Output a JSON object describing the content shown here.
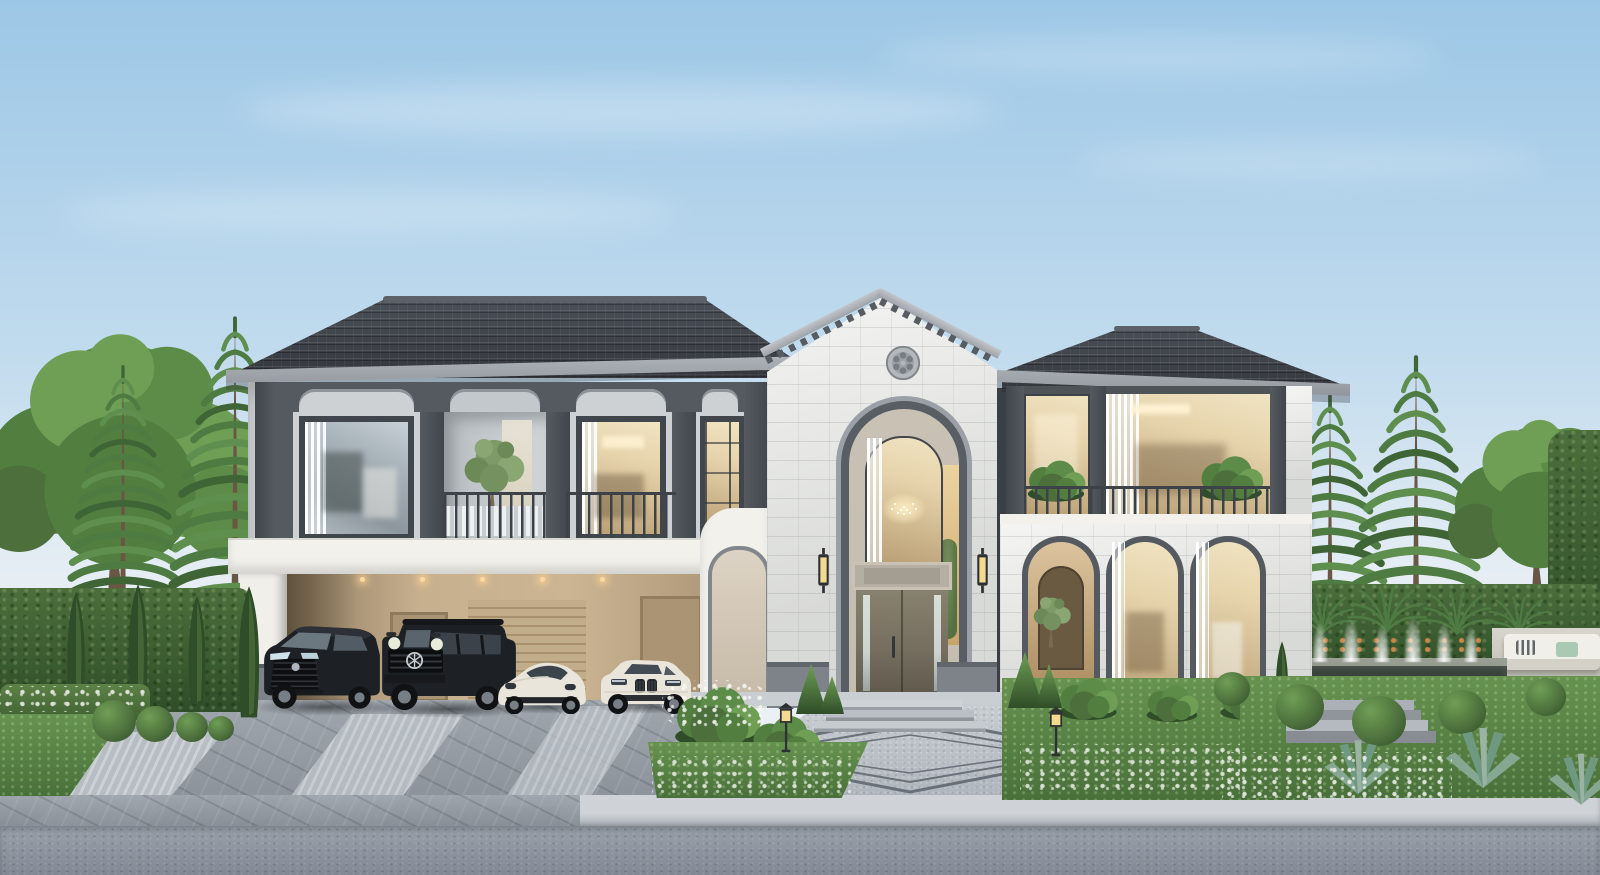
{
  "scene": {
    "type": "architectural-exterior-3d-render",
    "subject": "Two-story luxury modern-classical house with central gabled entry tower, arched entrance, carport with four cars, paver driveway, landscaped gardens, fountain and tall pine trees under a clear blue sky",
    "time_of_day": "daytime",
    "weather": "clear with thin clouds"
  },
  "house": {
    "style": "modern classical",
    "stories": 2,
    "left_wing": {
      "upper_bays": 4,
      "balcony": "open bay with olive tree and railing",
      "carport_cars": 4
    },
    "entry_tower": {
      "gable": "dentil rake boards",
      "rosette_medallion": true,
      "arched_window": "grid glazing with chandelier",
      "door": "grey double door with mirror sidelights",
      "wall_sconces": 2
    },
    "right_wing": {
      "upper": "glazed balcony with planters and railing",
      "ground_arches": 3,
      "first_arch": "open porch with tree"
    }
  },
  "vehicles": [
    {
      "name": "black-luxury-minivan",
      "color": "#1d2125"
    },
    {
      "name": "black-boxy-suv",
      "color": "#191c1f"
    },
    {
      "name": "white-sports-sedan",
      "color": "#eae5da"
    },
    {
      "name": "white-luxury-sedan",
      "color": "#ece8dd"
    }
  ],
  "landscape": {
    "left": [
      "deciduous tree",
      "norfolk pine",
      "norfolk pine",
      "tall hedge wall",
      "cypress shrubs",
      "boxwood balls",
      "lawn",
      "white flower bed"
    ],
    "right": [
      "norfolk pine",
      "norfolk pine",
      "deciduous tree",
      "hedge wall",
      "palm rosettes",
      "fountain pool with water jets",
      "outdoor lounge sofa",
      "garden steps",
      "boxwood balls",
      "agaves",
      "white flower bed",
      "cypress"
    ],
    "front": [
      "white flower beds",
      "garden lantern posts",
      "conical shrubs",
      "paver driveway with light stripes",
      "granite walkway with diamond inlay",
      "entry steps",
      "street curb",
      "asphalt road"
    ]
  },
  "colors": {
    "sky_top": "#9cc7e6",
    "sky_mid": "#c3dcee",
    "sky_horizon": "#e6eef4",
    "roof_dark": "#33373d",
    "roof_light": "#4d525a",
    "ridge": "#5d626a",
    "fascia_a": "#b0b5ba",
    "fascia_b": "#8f959b",
    "pier": "#555a61",
    "pier_dark": "#41464c",
    "wall_light": "#cdd1d4",
    "wall_recess": "#c3c8cc",
    "stone": "#e7e8e5",
    "band_white": "#f2f1ec",
    "carport_a": "#c7b08e",
    "carport_b": "#8d7a5f",
    "carport_door": "#ab9473",
    "glass_cool1": "#c7d1d6",
    "glass_cool2": "#8d979e",
    "glass_warm1": "#e6d3ab",
    "glass_warm2": "#b89d72",
    "reveal": "#c4bdb0",
    "door": "#766f60",
    "door_dark": "#5f594c",
    "sidelight": "#ccd3cf",
    "plinth": "#7e838a",
    "railing": "#3d4248",
    "hedge_a": "#4c6f3c",
    "hedge_b": "#2f4d28",
    "grass_a": "#679350",
    "grass_b": "#49703a",
    "pine_a": "#4e7b42",
    "pine_b": "#5f8f4f",
    "pine_c": "#3f6536",
    "canopy_a": "#5d8c49",
    "canopy_b": "#6f9e55",
    "canopy_c": "#527e40",
    "trunk": "#6a5645",
    "drive_a": "#9fa6ad",
    "drive_b": "#858c95",
    "stripe_a": "#ccd1d5",
    "stripe_b": "#b7bdc3",
    "walk_a": "#c9ced3",
    "walk_b": "#aeb4bb",
    "inlay": "#6a707a",
    "curb_a": "#cfd3d7",
    "curb_b": "#a8aeb5",
    "road_a": "#99a0aa",
    "road_b": "#828994",
    "pool": "#39423b",
    "pool_rim": "#8b9184",
    "flower_white": "#f6f7f2",
    "flower_orange": "#d98a4a",
    "glow": "#f5d98f",
    "downlight": "#ffd9a0",
    "car_black": "#1d2125",
    "car_black2": "#34393f",
    "car_white": "#eae5da",
    "car_white2": "#c9c3b5",
    "wheel": "#101214",
    "rim": "#777e85",
    "sofa": "#f0efe9",
    "cushion_green": "#a9c9b4"
  }
}
